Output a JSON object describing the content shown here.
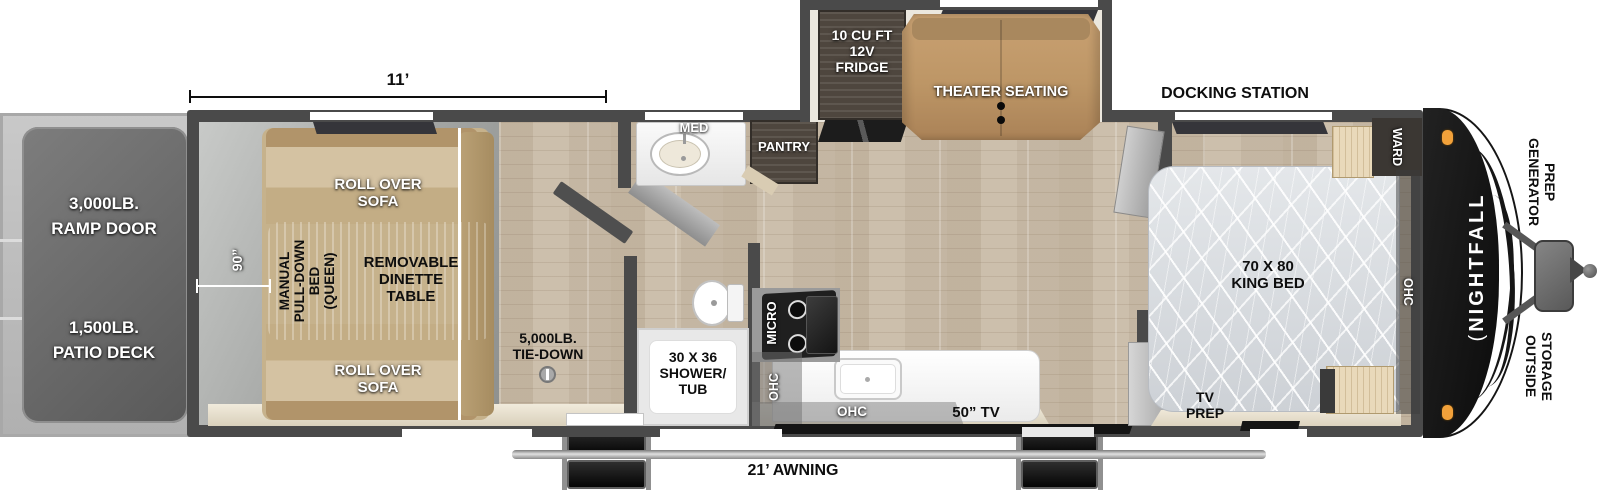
{
  "exterior_rear": {
    "ramp_door": "3,000LB.\nRAMP DOOR",
    "patio_deck": "1,500LB.\nPATIO DECK"
  },
  "dimensions": {
    "garage_length": "11’",
    "garage_width": "90”",
    "awning": "21’ AWNING"
  },
  "garage": {
    "sofa_top": "ROLL OVER\nSOFA",
    "sofa_bottom": "ROLL OVER\nSOFA",
    "pull_down_bed": "MANUAL\nPULL-DOWN\nBED\n(QUEEN)",
    "dinette_table": "REMOVABLE\nDINETTE\nTABLE",
    "tie_down": "5,000LB.\nTIE-DOWN"
  },
  "bathroom": {
    "med_cabinet": "MED",
    "shower_tub": "30 X 36\nSHOWER/\nTUB"
  },
  "kitchen": {
    "pantry": "PANTRY",
    "fridge": "10 CU FT\n12V\nFRIDGE",
    "theater_seating": "THEATER SEATING",
    "micro": "MICRO",
    "ohc_wall": "OHC",
    "ohc_counter": "OHC",
    "tv": "50” TV"
  },
  "bedroom": {
    "docking_station": "DOCKING STATION",
    "king_bed": "70 X 80\nKING BED",
    "ward": "WARD",
    "ohc": "OHC",
    "tv_prep": "TV\nPREP"
  },
  "exterior_front": {
    "brand_mark": "(",
    "brand_logo": "NIGHTFALL",
    "generator_prep": "GENERATOR\nPREP",
    "outside_storage": "OUTSIDE\nSTORAGE"
  },
  "colors": {
    "wall": "#4a4a4a",
    "floor_wood": "#c8bba8",
    "floor_garage": "#a2a4a2",
    "sofa_tan": "#c6b28c",
    "theater_tan": "#bd9666",
    "clearance_light": "#f2a13a"
  }
}
